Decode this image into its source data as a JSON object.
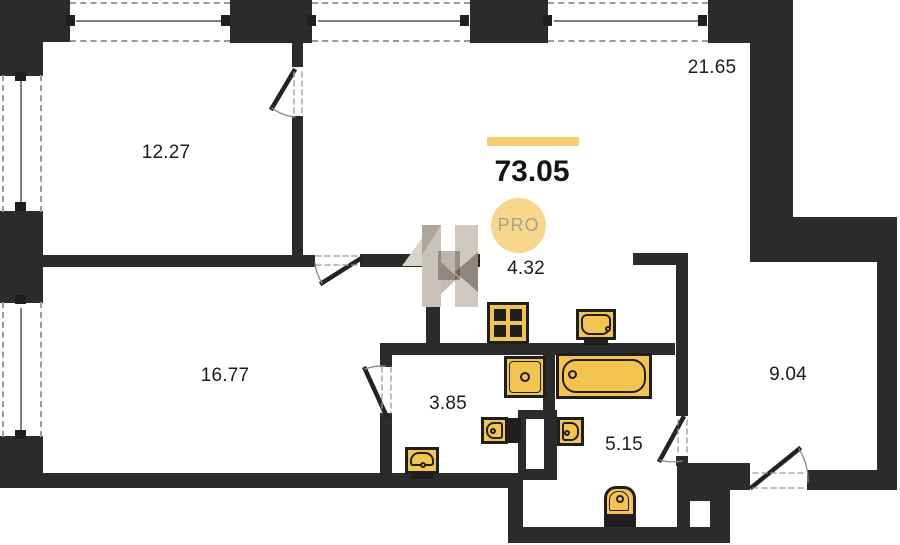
{
  "summary": {
    "total_area": "73.05",
    "badge": "PRO"
  },
  "room_areas": {
    "bedroom_top_left": "12.27",
    "living_kitchen": "21.65",
    "hallway": "4.32",
    "room_bottom_left": "16.77",
    "bathroom_small": "3.85",
    "bathroom_large": "5.15",
    "room_right": "9.04"
  },
  "fixture_icons": [
    "stove-icon",
    "kitchen-sink-icon",
    "washing-machine-icon",
    "bathtub-icon",
    "washbasin-icon",
    "toilet-icon"
  ],
  "colors": {
    "wall": "#2b2b2b",
    "fixture_fill": "#F3C44F",
    "accent_bar": "#F6CE6D",
    "badge_fill": "#F7D78C",
    "badge_text": "#ACA18A",
    "window_line": "#9b9b9b"
  }
}
